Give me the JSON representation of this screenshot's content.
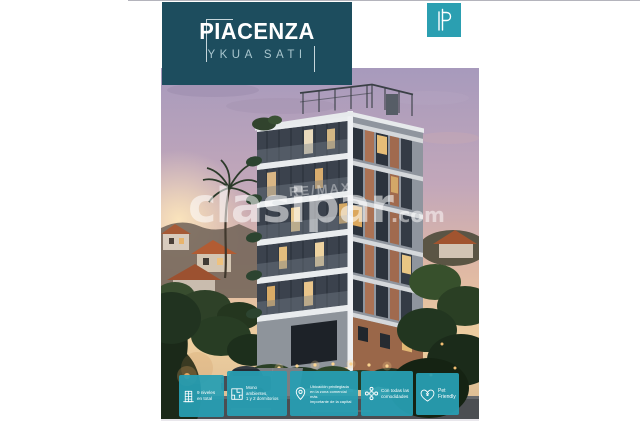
{
  "page": {
    "background": "#ffffff"
  },
  "header": {
    "title": "PIACENZA",
    "subtitle": "YKUA SATI"
  },
  "logo": {
    "icon": "clasipar-p-icon"
  },
  "watermark": {
    "text": "clasipar",
    "suffix": ".com"
  },
  "photo": {
    "banner": "RE/MAX"
  },
  "features": [
    {
      "icon": "building-levels-icon",
      "lines": [
        "9 niveles",
        "en total"
      ]
    },
    {
      "icon": "floorplan-icon",
      "lines": [
        "Mono",
        "ambientes,",
        "1 y 2 dormitorios"
      ]
    },
    {
      "icon": "location-pin-icon",
      "lines": [
        "Ubicación privilegiada",
        "en la zona comercial más",
        "importante de la capital"
      ]
    },
    {
      "icon": "amenities-icon",
      "lines": [
        "Con todas las",
        "comodidades"
      ]
    },
    {
      "icon": "pet-friendly-icon",
      "lines": [
        "Pet",
        "Friendly"
      ]
    }
  ],
  "colors": {
    "title_box": "#1d4d5e",
    "accent_teal": "#279eb2",
    "logo_teal": "#2b9fb1",
    "subtitle_text": "#a9c6ce",
    "watermark_white": "rgba(255,255,255,0.55)"
  }
}
